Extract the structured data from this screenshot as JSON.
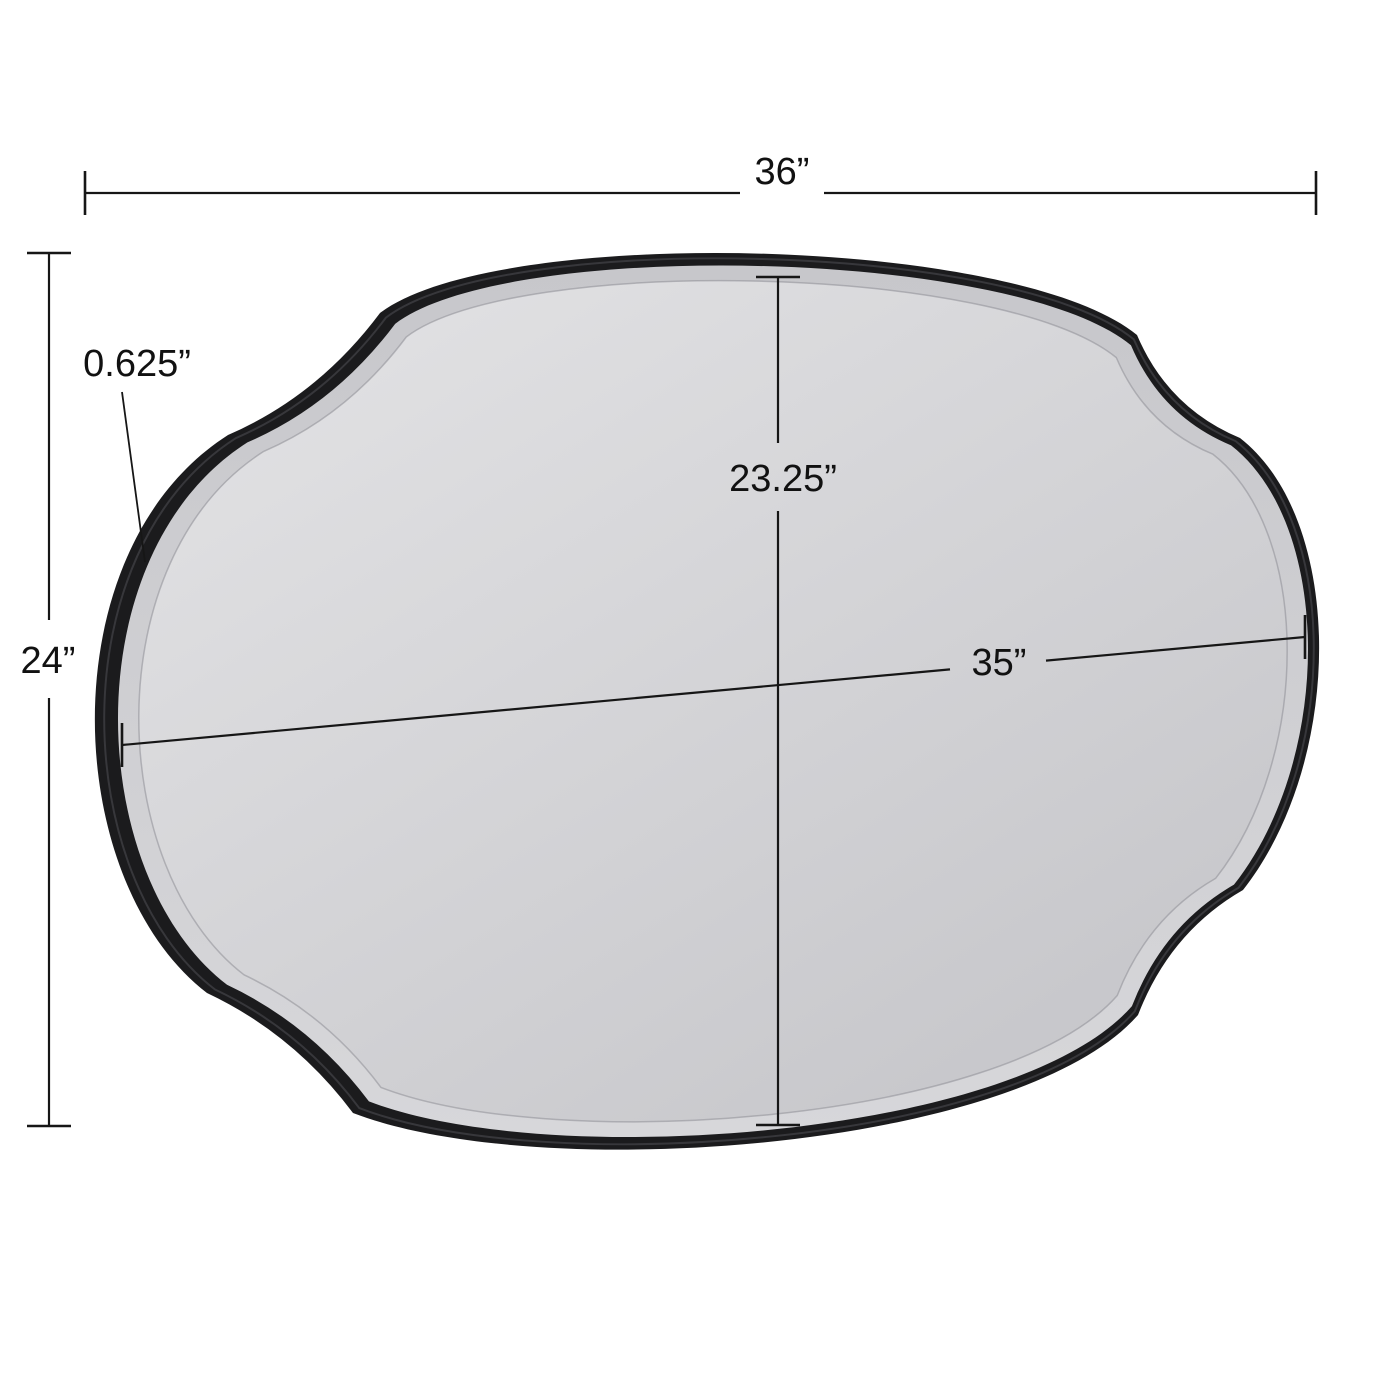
{
  "diagram": {
    "subject": "scalloped-oval-wall-mirror",
    "frame_style": "black scalloped frame with beveled mirror glass",
    "dimensions": {
      "overall_width": "36”",
      "overall_height": "24”",
      "frame_depth": "0.625”",
      "glass_height": "23.25”",
      "glass_width": "35”"
    },
    "colors": {
      "background": "#ffffff",
      "frame": "#1b1b1d",
      "frame_ridge": "#54545a",
      "bevel_ring_top": "#c7c7cb",
      "bevel_ring_bottom": "#d7d7da",
      "glass_light": "#e4e4e6",
      "glass_dark": "#c5c5c9",
      "bevel_edge": "#8e8e96",
      "dimension_line": "#161616",
      "label_text": "#111111"
    }
  }
}
